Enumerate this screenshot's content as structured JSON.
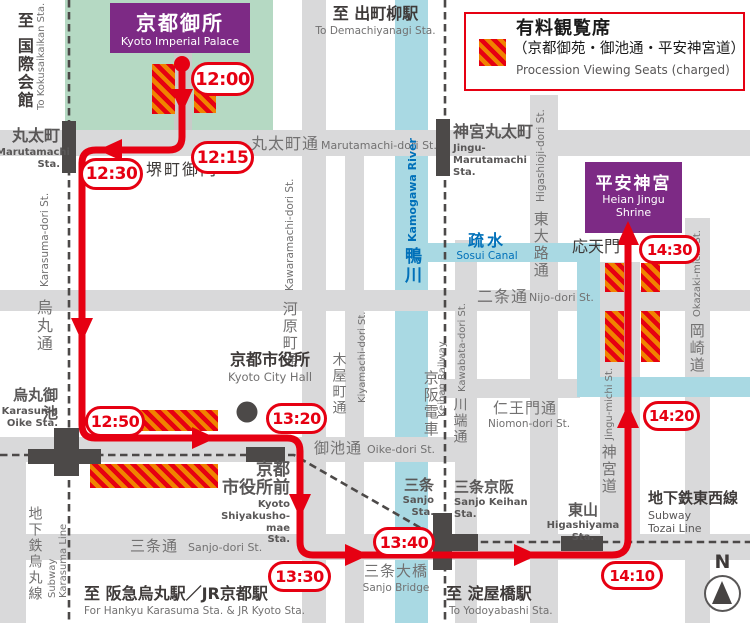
{
  "legend": {
    "title": "有料観覧席",
    "scope": "（京都御苑・御池通・平安神宮道）",
    "subtitle_en": "Procession Viewing Seats (charged)"
  },
  "route": {
    "times": [
      "12:00",
      "12:15",
      "12:30",
      "12:50",
      "13:20",
      "13:30",
      "13:40",
      "14:10",
      "14:20",
      "14:30"
    ]
  },
  "places": {
    "palace": {
      "ja": "京都御所",
      "en": "Kyoto Imperial Palace"
    },
    "heian": {
      "ja": "平安神宮",
      "en": "Heian Jingu\nShrine"
    },
    "city_hall": {
      "ja": "京都市役所",
      "en": "Kyoto City Hall"
    },
    "sakaimachi_gomon": {
      "ja": "堺町御門"
    },
    "otenmon": {
      "ja": "応天門"
    },
    "sanjo_bridge": {
      "ja": "三条大橋",
      "en": "Sanjo Bridge"
    },
    "sosui": {
      "ja": "疏水",
      "en": "Sosui Canal"
    },
    "kamogawa": {
      "ja": "鴨川",
      "en": "Kamogawa River"
    },
    "keihan": {
      "ja": "京阪電車",
      "en": "Keihan Railway"
    }
  },
  "stations": {
    "marutamachi": {
      "ja": "丸太町",
      "en": "Marutamachi\nSta."
    },
    "jingu_marutamachi": {
      "ja": "神宮丸太町",
      "en": "Jingu-\nMarutamachi\nSta."
    },
    "karasuma_oike": {
      "ja": "烏丸御池",
      "en": "Karasuma\nOike Sta."
    },
    "shiyakusho_mae": {
      "ja": "京都\n市役所前",
      "en": "Kyoto\nShiyakusho-mae\nSta."
    },
    "sanjo": {
      "ja": "三条",
      "en": "Sanjo\nSta."
    },
    "sanjo_keihan": {
      "ja": "三条京阪",
      "en": "Sanjo Keihan\nSta."
    },
    "higashiyama": {
      "ja": "東山",
      "en": "Higashiyama Sta."
    }
  },
  "streets": {
    "marutamachi_dori": {
      "ja": "丸太町通",
      "en": "Marutamachi-dori St."
    },
    "karasuma_dori": {
      "ja": "烏丸通",
      "en": "Karasuma-dori St."
    },
    "kawaramachi_dori": {
      "ja": "河原町通",
      "en": "Kawaramachi-dori St."
    },
    "kiyamachi_dori": {
      "ja": "木屋町通",
      "en": "Kiyamachi-dori St."
    },
    "kawabata_dori": {
      "ja": "川端通",
      "en": "Kawabata-dori St."
    },
    "oike_dori": {
      "ja": "御池通",
      "en": "Oike-dori St."
    },
    "nijo_dori": {
      "ja": "二条通",
      "en": "Nijo-dori St."
    },
    "sanjo_dori": {
      "ja": "三条通",
      "en": "Sanjo-dori St."
    },
    "niomon_dori": {
      "ja": "仁王門通",
      "en": "Niomon-dori St."
    },
    "higashioji_dori": {
      "ja": "東大路通",
      "en": "Higashioji-dori St."
    },
    "jingu_michi": {
      "ja": "神宮道",
      "en": "Jingu-michi St."
    },
    "okazaki_michi": {
      "ja": "岡崎道",
      "en": "Okazaki-michi St."
    }
  },
  "transit": {
    "karasuma_line": {
      "ja": "地下鉄烏丸線",
      "en": "Subway\nKarasuma Line"
    },
    "tozai_line": {
      "ja": "地下鉄東西線",
      "en": "Subway\nTozai Line"
    }
  },
  "directions": {
    "kokusaikaikan": {
      "ja": "至 国際会館",
      "en": "To Kokusaikaikan Sta."
    },
    "demachiyanagi": {
      "ja": "至 出町柳駅",
      "en": "To Demachiyanagi Sta."
    },
    "hankyu_jr": {
      "ja": "至 阪急烏丸駅／JR京都駅",
      "en": "For Hankyu Karasuma Sta. & JR Kyoto Sta."
    },
    "yodoyabashi": {
      "ja": "至 淀屋橋駅",
      "en": "To Yodoyabashi Sta."
    }
  },
  "compass": {
    "north": "N"
  },
  "colors": {
    "route_red": "#e60012",
    "seat_orange": "#f08300",
    "palace_green": "#b5d9c3",
    "water_blue": "#a9d9e3",
    "shrine_purple": "#7d2a85",
    "street_gray": "#d9d9da",
    "line_dark_gray": "#4c4948",
    "station_text_gray": "#595757",
    "water_text_blue": "#0070b9"
  }
}
